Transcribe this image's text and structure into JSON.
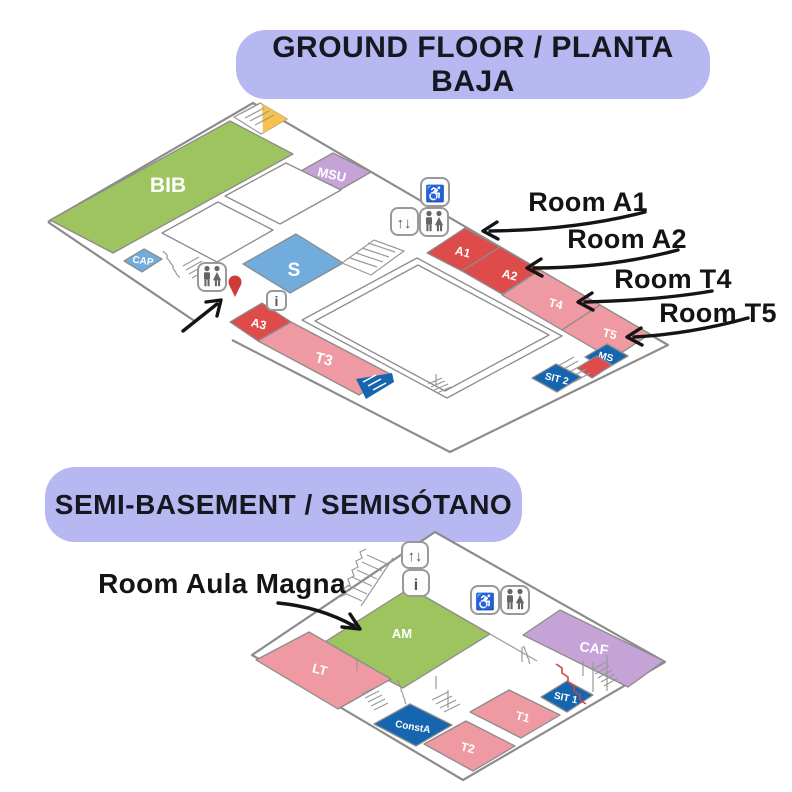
{
  "ground_floor": {
    "title": "GROUND FLOOR / PLANTA BAJA",
    "rooms": {
      "bib": "BIB",
      "msu": "MSU",
      "cap": "CAP",
      "s": "S",
      "a1": "A1",
      "a2": "A2",
      "t4": "T4",
      "t5": "T5",
      "a3": "A3",
      "t3": "T3",
      "ms": "MS",
      "sit2": "SIT 2"
    },
    "annotations": {
      "a1": "Room A1",
      "a2": "Room A2",
      "t4": "Room T4",
      "t5": "Room T5"
    }
  },
  "basement": {
    "title": "SEMI-BASEMENT / SEMISÓTANO",
    "rooms": {
      "am": "AM",
      "lt": "LT",
      "caf": "CAF",
      "sit1": "SIT 1",
      "t1": "T1",
      "t2": "T2",
      "consta": "ConstA"
    },
    "annotations": {
      "am": "Room Aula Magna"
    }
  },
  "icons": {
    "elevator": "↑↓",
    "info": "i",
    "wheelchair": "♿"
  },
  "colors": {
    "green": "#9dc45f",
    "purple": "#c6a3d6",
    "blue": "#72acdc",
    "dark_blue": "#1566ae",
    "red": "#de4b4b",
    "pink": "#ef99a2",
    "yellow": "#f6c14d",
    "lavender": "#b7b7f2",
    "pin_red": "#cf3b3b",
    "outline": "#8c8c8c"
  }
}
